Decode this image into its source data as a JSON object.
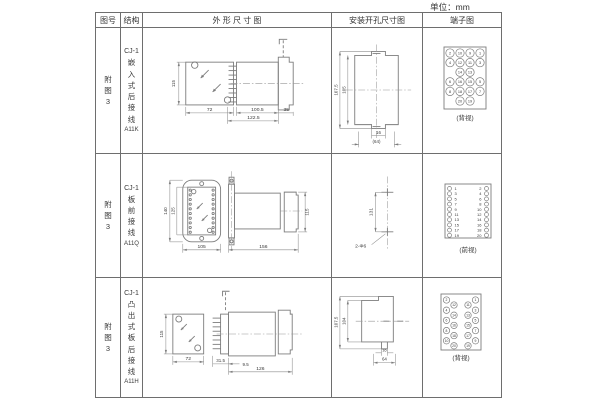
{
  "unit_label": "单位：mm",
  "header": {
    "figure": "图号",
    "structure": "结构",
    "outline": "外 形 尺 寸 图",
    "mounting": "安装开孔尺寸图",
    "terminal": "端子图"
  },
  "rows": [
    {
      "figure_no": "附图3",
      "model_series": "CJ-1",
      "structure_name": "嵌入式后接线",
      "model_code": "A11K",
      "outline": {
        "front_height": "115",
        "front_width": "72",
        "body_length": "100.5",
        "total_length": "122.5",
        "flange_depth": "35"
      },
      "mounting": {
        "outer_height": "107.5",
        "inner_height": "105",
        "hole_pitch": "16",
        "width": "(64)"
      },
      "terminal": {
        "caption": "(背视)",
        "grid": [
          [
            "2",
            "10",
            "9",
            "1"
          ],
          [
            "4",
            "12",
            "11",
            "3"
          ],
          [
            "",
            "14",
            "13",
            ""
          ],
          [
            "6",
            "16",
            "15",
            "5"
          ],
          [
            "8",
            "18",
            "17",
            "7"
          ],
          [
            "",
            "20",
            "19",
            ""
          ]
        ]
      }
    },
    {
      "figure_no": "附图3",
      "model_series": "CJ-1",
      "structure_name": "板前接线",
      "model_code": "A11Q",
      "outline": {
        "front_outer_height": "140",
        "front_inner_height": "125",
        "front_width": "105",
        "side_length": "156",
        "side_height": "115"
      },
      "mounting": {
        "hole_pitch": "131",
        "hole_label": "2-Φ6"
      },
      "terminal": {
        "caption": "(前视)",
        "left": [
          "1",
          "3",
          "5",
          "7",
          "9",
          "11",
          "13",
          "15",
          "17",
          "19"
        ],
        "right": [
          "2",
          "4",
          "6",
          "8",
          "10",
          "12",
          "14",
          "16",
          "18",
          "20"
        ]
      }
    },
    {
      "figure_no": "附图3",
      "model_series": "CJ-1",
      "structure_name": "凸出式板后接线",
      "model_code": "A11H",
      "outline": {
        "front_height": "115",
        "front_width": "72",
        "front_depth": "31.5",
        "gap": "9.5",
        "body_length": "126"
      },
      "mounting": {
        "outer_height": "107.5",
        "inner_height": "104",
        "hole_pitch": "16",
        "width": "64"
      },
      "terminal": {
        "caption": "(背视)",
        "left_outer": [
          "2",
          "4",
          "6",
          "8",
          "10"
        ],
        "left_inner": [
          "12",
          "14",
          "16",
          "18",
          "20"
        ],
        "right_inner": [
          "11",
          "13",
          "15",
          "17",
          "19"
        ],
        "right_outer": [
          "1",
          "3",
          "5",
          "7",
          "9"
        ]
      }
    }
  ]
}
